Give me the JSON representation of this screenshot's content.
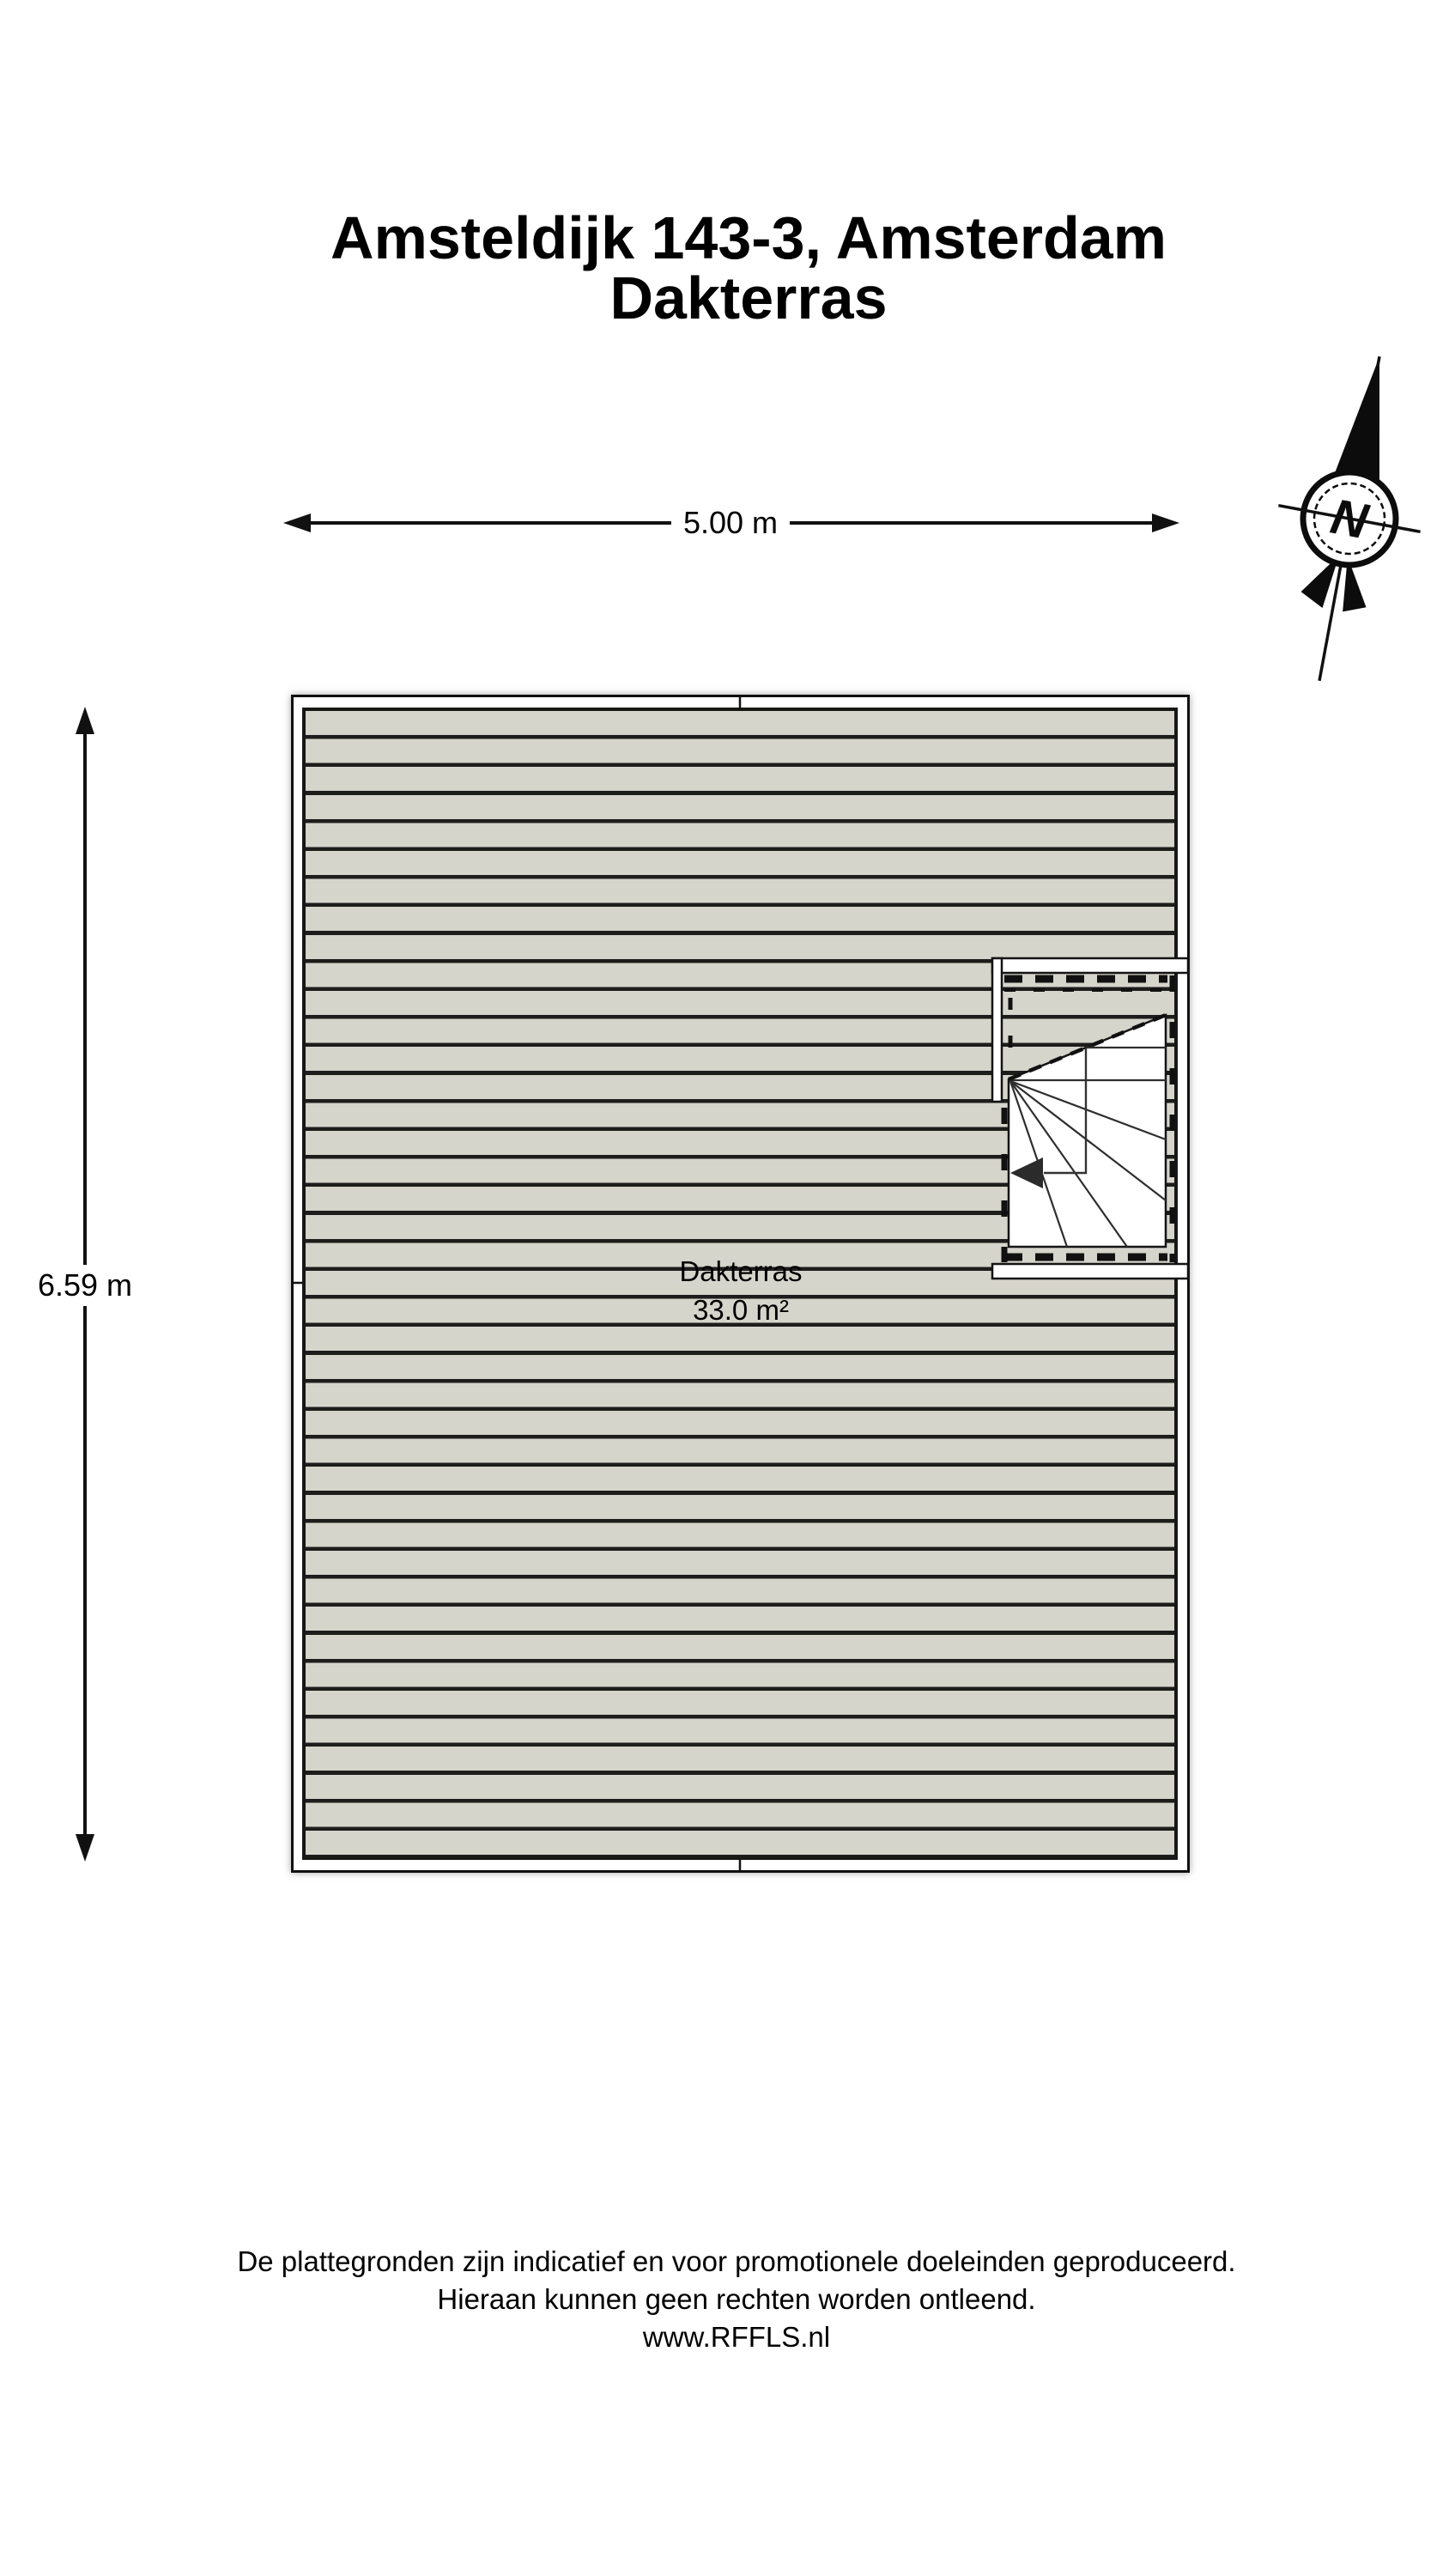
{
  "title": {
    "line1": "Amsteldijk 143-3, Amsterdam",
    "line2": "Dakterras"
  },
  "compass": {
    "north_label": "N"
  },
  "dimensions": {
    "width_label": "5.00 m",
    "height_label": "6.59 m"
  },
  "floor_plan": {
    "room_name": "Dakterras",
    "room_area": "33.0 m²",
    "deck_color": "#d6d5cc",
    "plank_line_color": "#1d1d1b"
  },
  "footer": {
    "line1": "De plattegronden zijn indicatief en voor promotionele doeleinden geproduceerd.",
    "line2": "Hieraan kunnen geen rechten worden ontleend.",
    "line3": "www.RFFLS.nl"
  }
}
